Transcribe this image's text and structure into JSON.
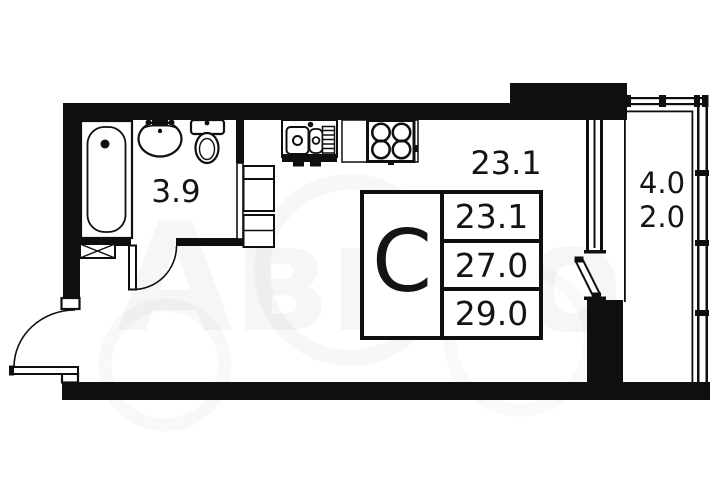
{
  "watermark": {
    "text": "Авито"
  },
  "rooms": {
    "bathroom": {
      "area": "3.9"
    },
    "main": {
      "area": "23.1"
    },
    "balcony": {
      "area_line1": "4.0",
      "area_line2": "2.0"
    }
  },
  "legend": {
    "letter": "С",
    "values": [
      "23.1",
      "27.0",
      "29.0"
    ]
  },
  "colors": {
    "wall": "#0f0f0f",
    "text": "#141414",
    "background": "#ffffff"
  }
}
